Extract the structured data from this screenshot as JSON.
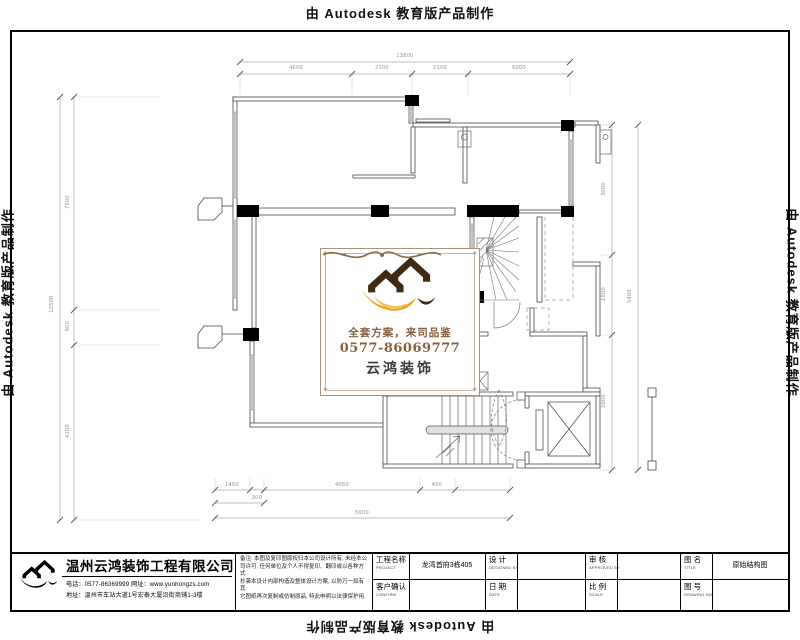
{
  "watermark": {
    "text": "由 Autodesk 教育版产品制作"
  },
  "stamp": {
    "slogan": "全套方案，来司品鉴",
    "phone": "0577-86069777",
    "brand": "云鸿装饰",
    "colors": {
      "roof": "#3f2a14",
      "swoosh": "#efa224",
      "text_brown": "#8a5f3f"
    }
  },
  "title_block": {
    "company": {
      "name": "温州云鸿装饰工程有限公司",
      "tel": "电话：0577-86369999",
      "web": "网址：www.yunhongzs.com",
      "address": "地址：温州市车站大道1号宏泰大厦沿街商铺1-3楼"
    },
    "notes": {
      "line1": "备注: 本图及复印图版权归本公司设计所有, 未经本公",
      "line2": "司许可, 任何单位及个人不得复印、翻印或以各种方式",
      "line3": "抄袭本设计内部构造及整体设计方案, 以防万一如有其",
      "line4": "它图纸再次复制或仿制原品, 特此申明以法律保护用."
    },
    "fields": {
      "project": {
        "label": "工程名称",
        "en": "PROJECT",
        "value": "龙湾首府3栋405"
      },
      "confirm": {
        "label": "客户确认",
        "en": "CONFIRM",
        "value": ""
      },
      "design": {
        "label": "设 计",
        "en": "DESIGNED BY",
        "value": ""
      },
      "date": {
        "label": "日 期",
        "en": "DATE",
        "value": ""
      },
      "approve": {
        "label": "审 核",
        "en": "APPROVED BY",
        "value": ""
      },
      "scale": {
        "label": "比 例",
        "en": "SCALE",
        "value": ""
      },
      "title": {
        "label": "图 名",
        "en": "TITLE",
        "value": "原始结构图"
      },
      "number": {
        "label": "图 号",
        "en": "DRAWING NO",
        "value": ""
      }
    }
  },
  "dims": {
    "top": {
      "overall": "13800",
      "segments": [
        "4600",
        "2100",
        "2100",
        "5000"
      ]
    },
    "left": {
      "overall": "12500",
      "segments": [
        "7500",
        "900",
        "4100"
      ]
    },
    "right": {
      "overall": "5400",
      "segments": [
        "3000",
        "1800",
        "2000"
      ]
    },
    "bottom": {
      "overall": "5900",
      "segments": [
        "1450",
        "300",
        "4050",
        "450"
      ]
    }
  }
}
